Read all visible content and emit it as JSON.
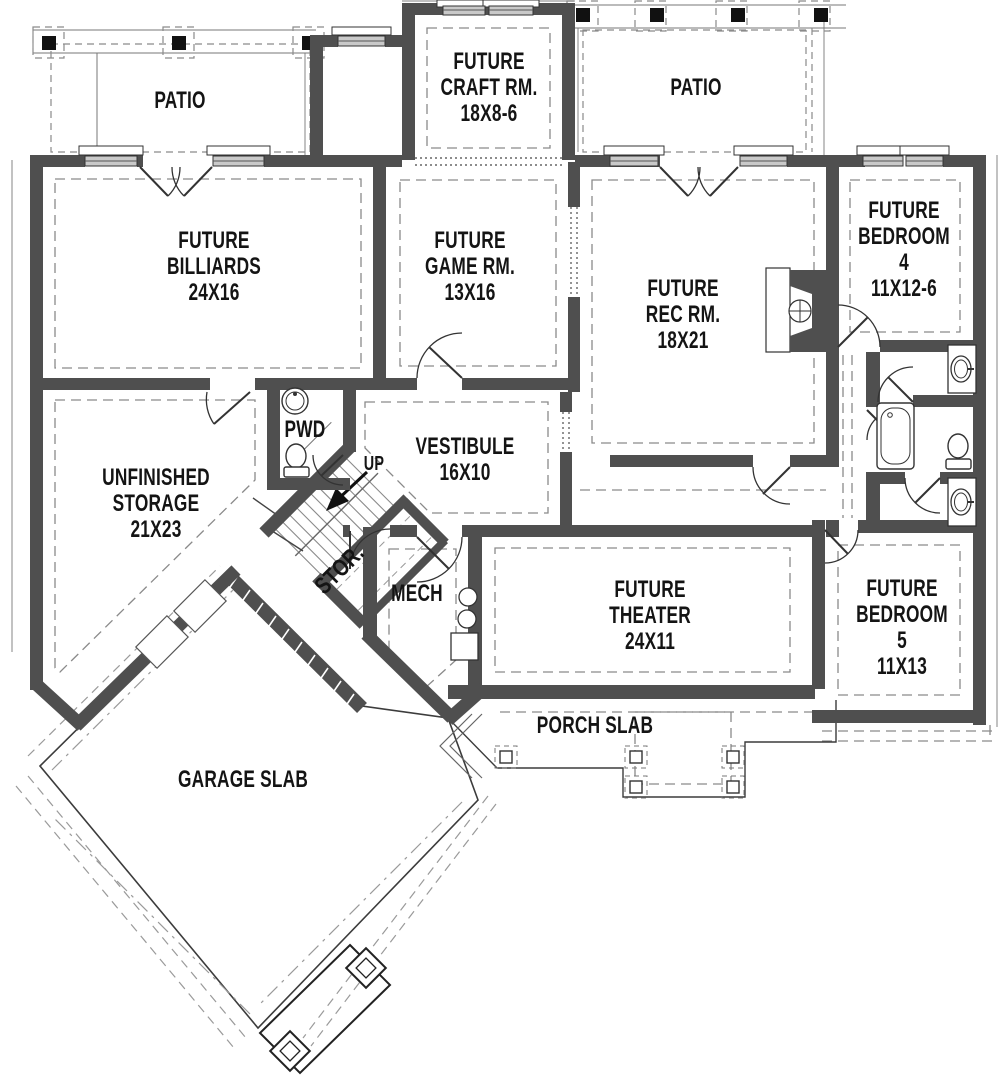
{
  "canvas": {
    "width": 1000,
    "height": 1075
  },
  "colors": {
    "wall": "#4f4f4f",
    "line": "#333333",
    "thin": "#6b6b6b",
    "dashed": "#8a8a8a",
    "text": "#141414",
    "window_fill": "#c9c9c9"
  },
  "rooms": [
    {
      "name": "patio-left",
      "label": "PATIO"
    },
    {
      "name": "craft-room",
      "label": "FUTURE\nCRAFT RM.\n18X8-6"
    },
    {
      "name": "patio-right",
      "label": "PATIO"
    },
    {
      "name": "billiards",
      "label": "FUTURE\nBILLIARDS\n24X16"
    },
    {
      "name": "game-room",
      "label": "FUTURE\nGAME RM.\n13X16"
    },
    {
      "name": "rec-room",
      "label": "FUTURE\nREC RM.\n18X21"
    },
    {
      "name": "bedroom-4",
      "label": "FUTURE\nBEDROOM 4\n11X12-6"
    },
    {
      "name": "storage",
      "label": "UNFINISHED\nSTORAGE\n21X23"
    },
    {
      "name": "powder-room",
      "label": "PWD"
    },
    {
      "name": "vestibule",
      "label": "VESTIBULE\n16X10"
    },
    {
      "name": "stairs-up",
      "label": "UP"
    },
    {
      "name": "stair-storage",
      "label": "STOR."
    },
    {
      "name": "mechanical",
      "label": "MECH"
    },
    {
      "name": "theater",
      "label": "FUTURE\nTHEATER\n24X11"
    },
    {
      "name": "bedroom-5",
      "label": "FUTURE\nBEDROOM 5\n11X13"
    },
    {
      "name": "porch-slab",
      "label": "PORCH SLAB"
    },
    {
      "name": "garage-slab",
      "label": "GARAGE SLAB"
    }
  ]
}
